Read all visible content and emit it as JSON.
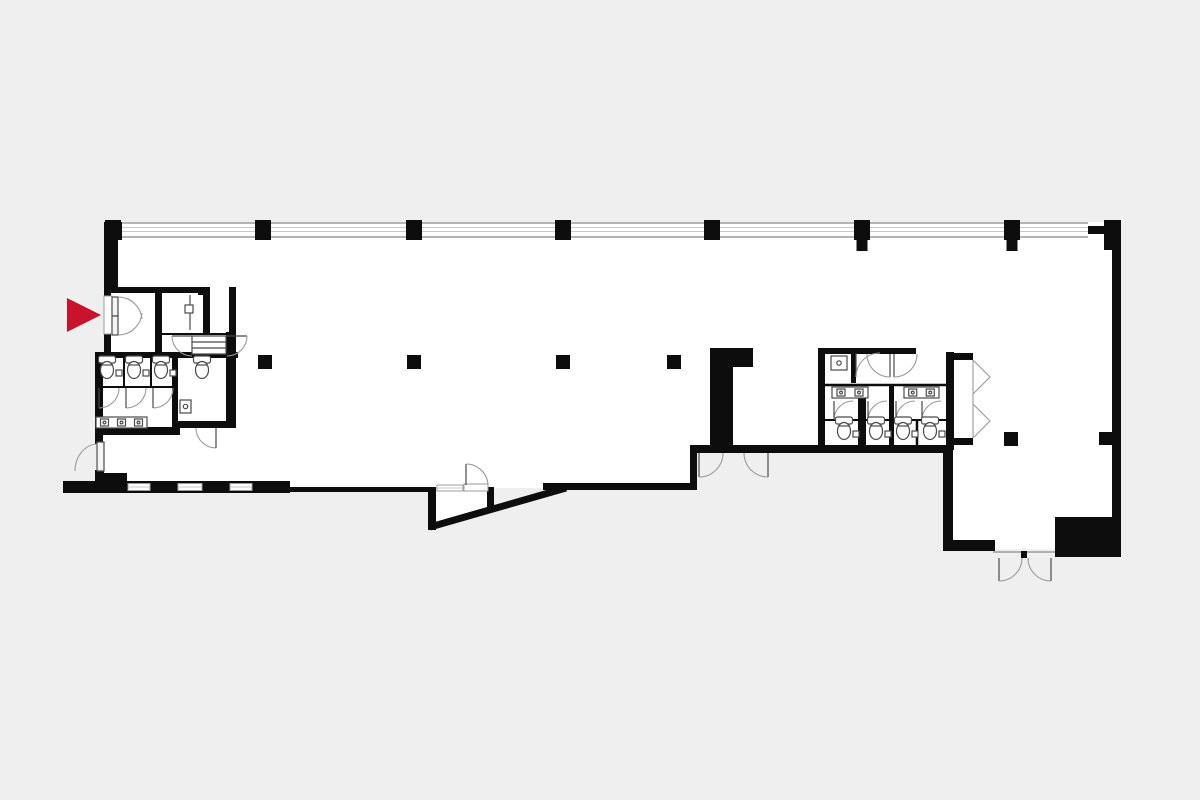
{
  "page": {
    "kind": "architectural-floor-plan",
    "description": "black-and-white office floor plan with red entrance marker",
    "visible_text": ""
  },
  "colors": {
    "background": "#efefef",
    "floor": "#ffffff",
    "wall": "#0d0d0d",
    "window_line": "#9b9b9b",
    "window_light": "#c9c9c9",
    "fixture_line": "#4a4a4a",
    "arc_line": "#9a9a9a",
    "door_fill": "#f4f4f4",
    "marker_red": "#c9132b"
  },
  "marker": {
    "shape": "triangle",
    "direction": "right",
    "tip_x": 101,
    "tip_y": 315,
    "size": 34
  },
  "structure": {
    "curtain_wall": {
      "x1": 104,
      "x2": 1088,
      "y_top": 223,
      "y_mid1": 227.5,
      "y_mid2": 231.5,
      "y_bottom": 237
    },
    "top_columns": {
      "y": 220,
      "w": 16,
      "h": 20,
      "x_centers": [
        113,
        263,
        414,
        563,
        712,
        862,
        1012
      ],
      "stub_x_centers": [
        862,
        1012
      ],
      "stub_w": 11,
      "stub_h": 11
    },
    "interior_columns": [
      {
        "x": 265,
        "y": 362
      },
      {
        "x": 414,
        "y": 362
      },
      {
        "x": 563,
        "y": 362
      },
      {
        "x": 674,
        "y": 362
      },
      {
        "x": 1011,
        "y": 439
      }
    ],
    "interior_column_size": 14,
    "bottom_windows": {
      "y": 483.5,
      "h": 7,
      "segments": [
        [
          128,
          150
        ],
        [
          178,
          202
        ],
        [
          230,
          252
        ]
      ]
    }
  },
  "fixtures": {
    "toilets": [
      {
        "x": 107,
        "y": 366,
        "flush": true
      },
      {
        "x": 134,
        "y": 366,
        "flush": true
      },
      {
        "x": 161,
        "y": 366,
        "flush": true
      },
      {
        "x": 202,
        "y": 366,
        "flush": false
      },
      {
        "x": 844,
        "y": 427,
        "flush": true
      },
      {
        "x": 876,
        "y": 427,
        "flush": true
      },
      {
        "x": 903,
        "y": 427,
        "flush": true
      },
      {
        "x": 930,
        "y": 427,
        "flush": true
      }
    ],
    "sink_counters": [
      {
        "x": 96,
        "y": 417,
        "w": 51,
        "h": 11,
        "basins": 3
      },
      {
        "x": 832,
        "y": 387,
        "w": 36,
        "h": 11,
        "basins": 2
      },
      {
        "x": 904,
        "y": 387,
        "w": 35,
        "h": 11,
        "basins": 2
      }
    ],
    "small_sinks": [
      {
        "x": 180,
        "y": 400,
        "w": 11,
        "h": 13
      },
      {
        "x": 831,
        "y": 356,
        "w": 16,
        "h": 14
      }
    ]
  }
}
